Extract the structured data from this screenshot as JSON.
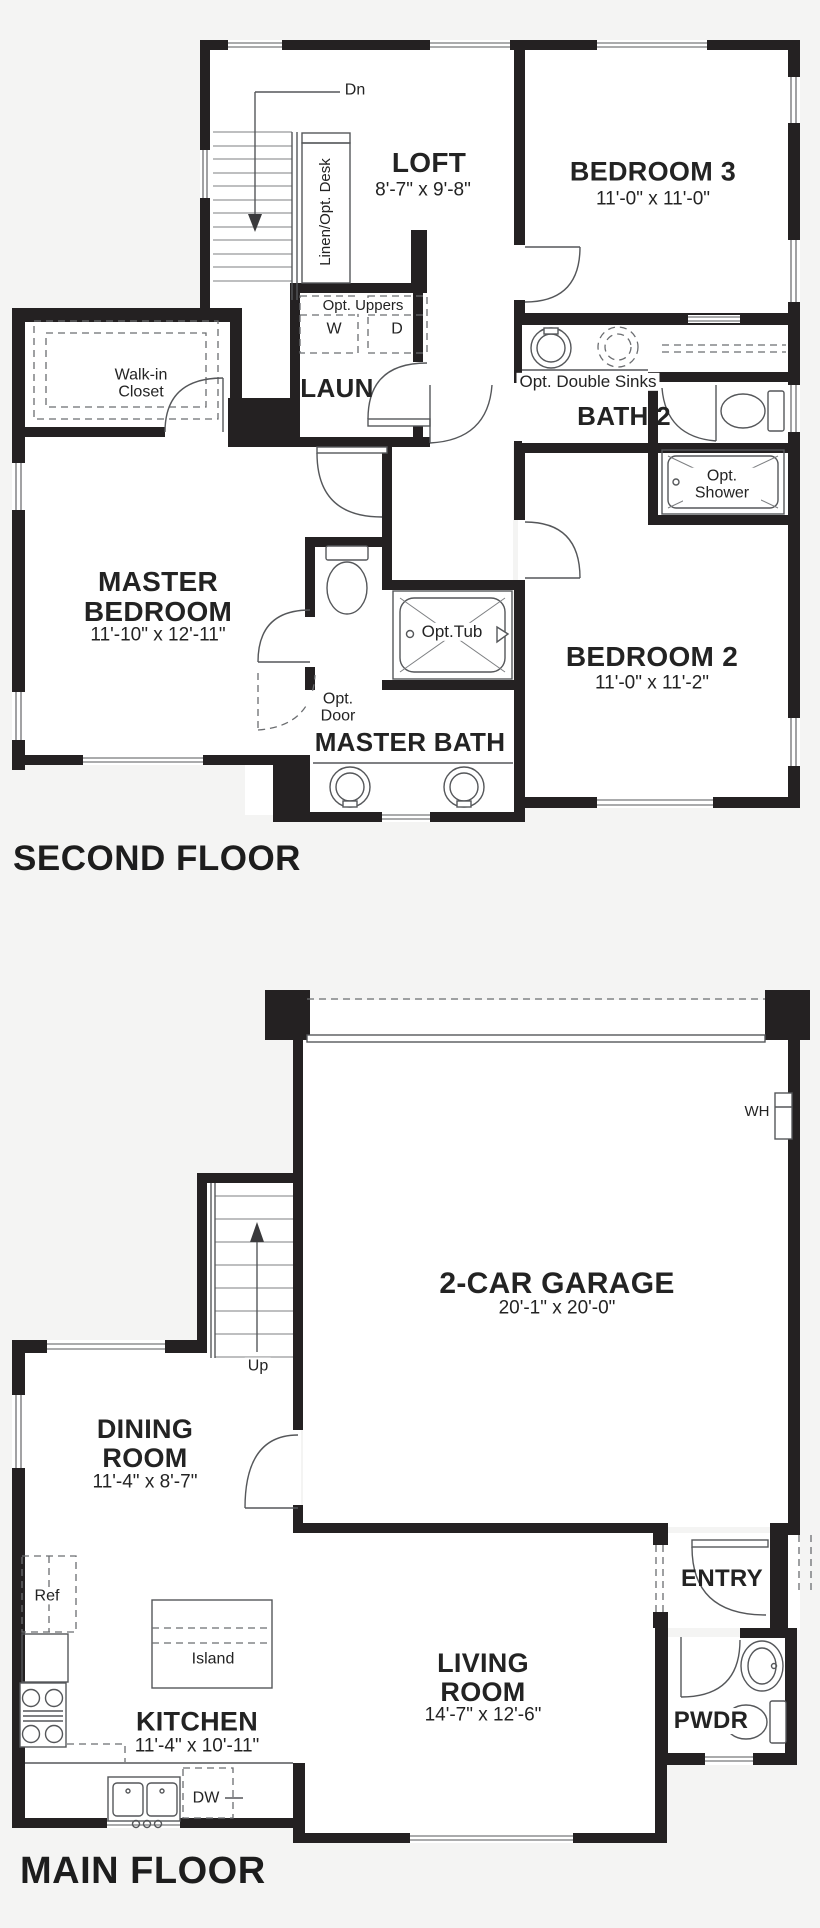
{
  "canvas": {
    "background": "#f4f4f3",
    "wall_color": "#242122",
    "line_color": "#55575a",
    "floor_color": "#ffffff"
  },
  "second_floor": {
    "title": "SECOND FLOOR",
    "rooms": {
      "loft": {
        "name": "LOFT",
        "dims": "8'-7\" x 9'-8\""
      },
      "bedroom3": {
        "name": "BEDROOM 3",
        "dims": "11'-0\" x 11'-0\""
      },
      "laundry": {
        "name": "LAUN"
      },
      "walk_in_closet": {
        "name": "Walk-in Closet"
      },
      "bath2": {
        "name": "BATH 2"
      },
      "master_bedroom": {
        "name": "MASTER BEDROOM",
        "dims": "11'-10\" x 12'-11\""
      },
      "bedroom2": {
        "name": "BEDROOM 2",
        "dims": "11'-0\" x 11'-2\""
      },
      "master_bath": {
        "name": "MASTER BATH"
      }
    },
    "labels": {
      "down": "Dn",
      "linen_desk": "Linen/Opt. Desk",
      "opt_uppers": "Opt. Uppers",
      "washer": "W",
      "dryer": "D",
      "opt_double_sinks": "Opt. Double Sinks",
      "opt_shower": "Opt. Shower",
      "opt_tub": "Opt.Tub",
      "opt_door": "Opt. Door"
    }
  },
  "main_floor": {
    "title": "MAIN FLOOR",
    "rooms": {
      "garage": {
        "name": "2-CAR GARAGE",
        "dims": "20'-1\" x 20'-0\""
      },
      "dining_room": {
        "name": "DINING ROOM",
        "dims": "11'-4\" x 8'-7\""
      },
      "kitchen": {
        "name": "KITCHEN",
        "dims": "11'-4\" x 10'-11\""
      },
      "living_room": {
        "name": "LIVING ROOM",
        "dims": "14'-7\" x 12'-6\""
      },
      "entry": {
        "name": "ENTRY"
      },
      "powder": {
        "name": "PWDR"
      }
    },
    "labels": {
      "up": "Up",
      "water_heater": "WH",
      "refrigerator": "Ref",
      "island": "Island",
      "dishwasher": "DW"
    }
  }
}
